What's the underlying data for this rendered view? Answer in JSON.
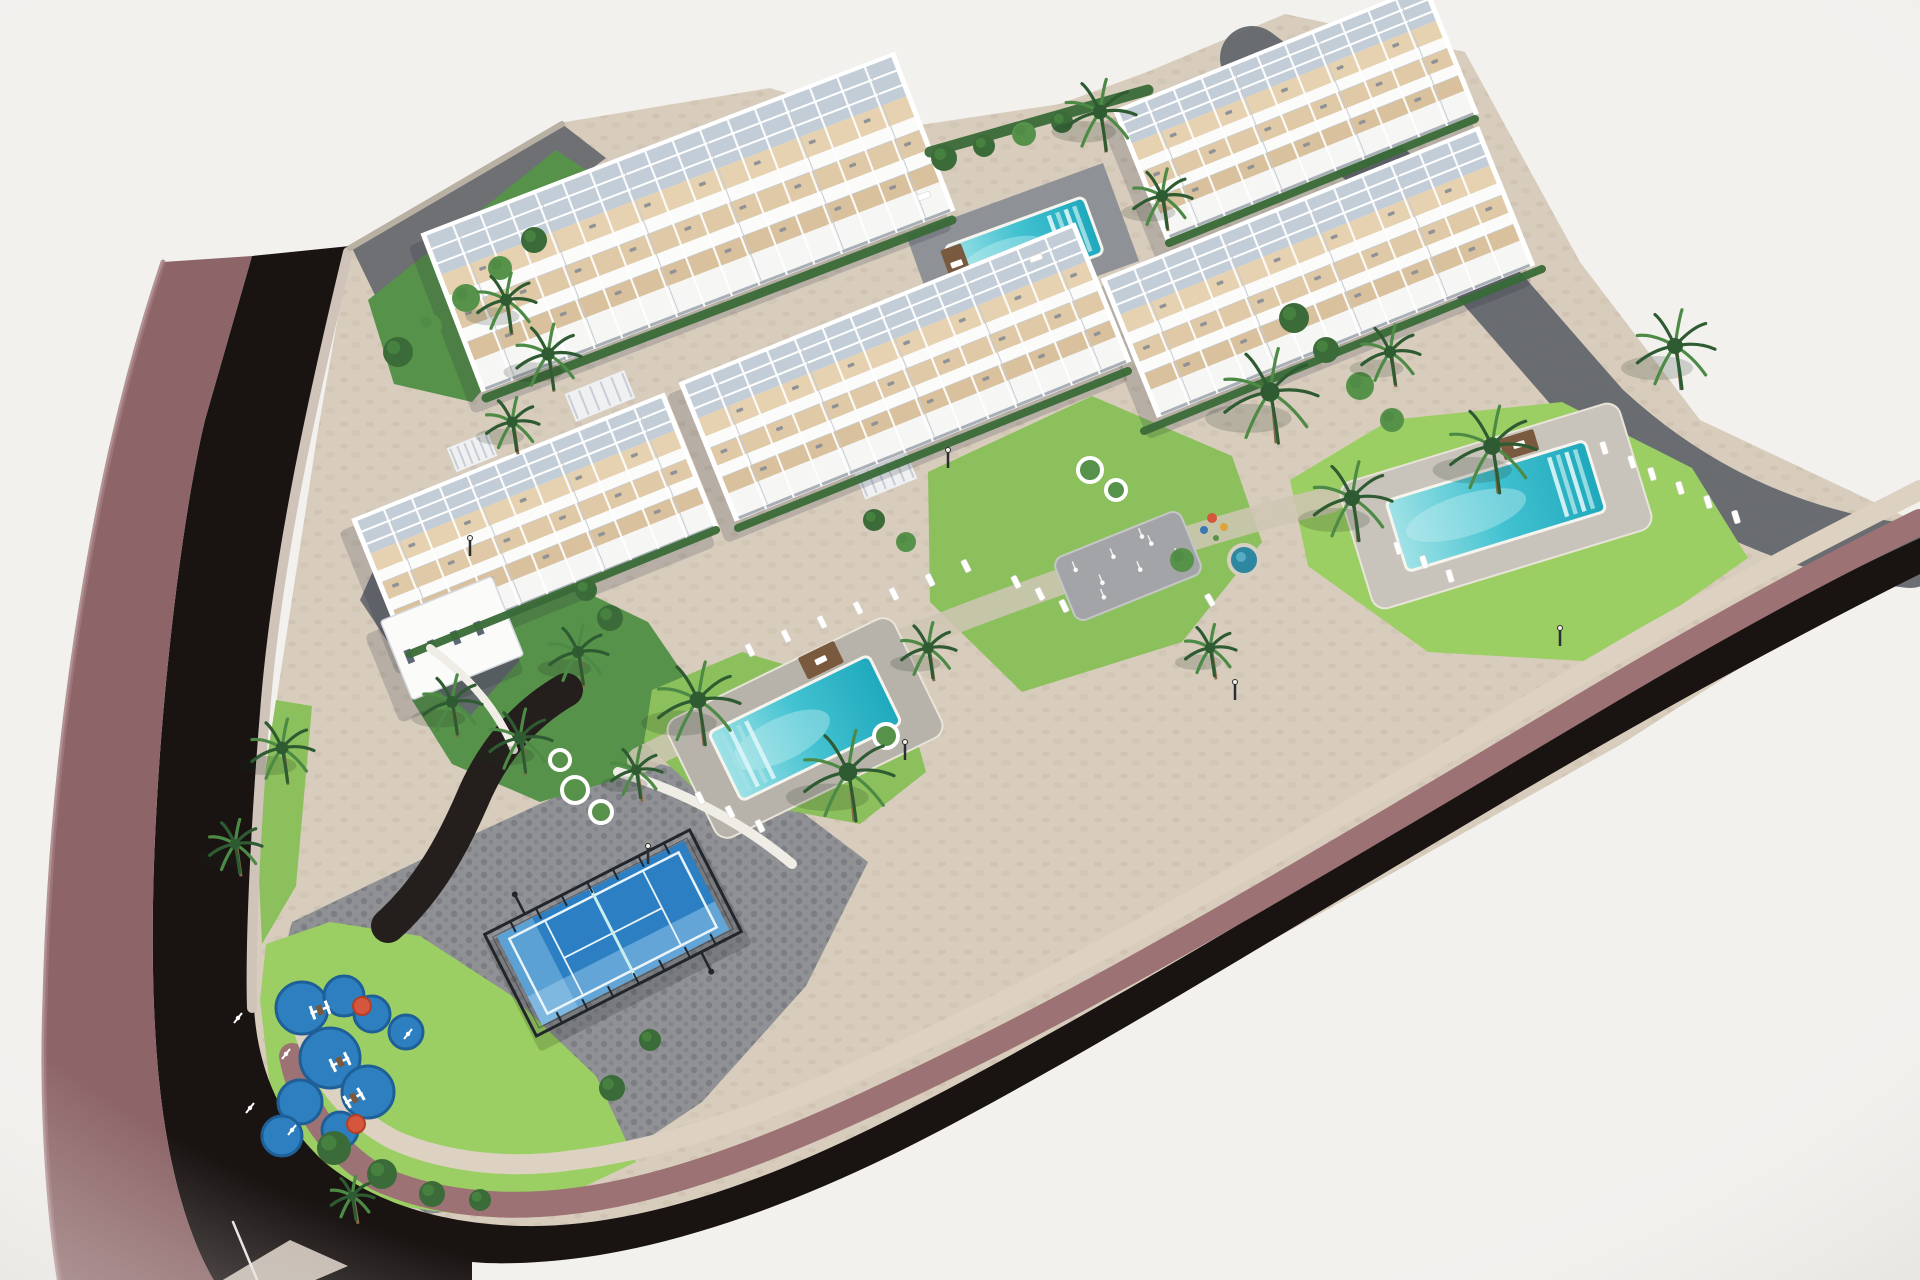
{
  "meta": {
    "type": "architectural-aerial-3d-render",
    "subject": "Aerial master-plan render of a white terraced apartment complex with swimming pools, gardens, palm trees, padel court and playground beside a curving dark road"
  },
  "palette": {
    "bg": "#f2f1ee",
    "road": "#191312",
    "sidewalk": "#8d6568",
    "sidewalk_hi": "#a17b7d",
    "curb": "#cfc3ba",
    "wall": "#9c7274",
    "cap": "#ddd1c2",
    "site": "#d8cdbd",
    "speck": "#c9bcab",
    "paving_dark": "#63666c",
    "pavers": "#8f9195",
    "paver_dot": "#7c7e83",
    "path_light": "#cfc5b4",
    "lawn": "#8cc05c",
    "lawn_bright": "#9ccf63",
    "green_mid": "#57924a",
    "green_dark": "#3a6b38",
    "palm_dark": "#2e5b31",
    "palm_mid": "#4d8a45",
    "trunk": "#8a6a4a",
    "water_hi": "#9fe2e6",
    "water": "#43c2d1",
    "water_deep": "#1fa9bd",
    "deck_p2": "#c9c4bb",
    "deck_p3": "#b8b3aa",
    "deck_dark": "#8e9196",
    "white": "#fbfbfa",
    "beige1": "#e6d2b0",
    "beige2": "#dfc9a6",
    "beige3": "#d8c19c",
    "pergola": "#c3cdd7",
    "slabline": "#c6cbd2",
    "frontline": "#a9afb7",
    "dot": "#8f9296",
    "shadow": "rgba(33,40,56,0.18)",
    "court": "#2b7fc2",
    "court_hi": "#5ea5d8",
    "glass": "#a8d4ef",
    "cage": "#20262c",
    "line_w": "#eaf4fb",
    "play": "#2e7fc0",
    "play_dark": "#1f5f97",
    "red": "#d4573d",
    "splash": "#a3a4a7",
    "wood": "#7a5a3e",
    "white_wall": "#efede6"
  },
  "scene": {
    "w": 1920,
    "h": 1280,
    "base": "350,248 565,122 770,88 900,128 1060,104 1152,70 1285,14 1465,52 1580,262 1700,420 1912,520 1908,560 1620,745 1300,925 1000,1085 760,1185 560,1240 400,1262 285,1215 248,1100 248,950 278,690 318,430",
    "areas": [
      {
        "name": "paving-topleft",
        "pts": "352,248 562,124 606,158 388,322",
        "fill": "@paving_dark",
        "op": 0.9
      },
      {
        "name": "garden-topleft",
        "pts": "368,300 556,150 628,198 588,268 472,402 394,384",
        "fill": "@green_mid"
      },
      {
        "name": "wall-band-topright",
        "d": "M 1252,58 C 1390,160 1500,300 1600,412 C 1700,505 1810,545 1910,556",
        "stroke": "@paving_dark",
        "sw": 64,
        "op": 0.95
      },
      {
        "name": "plaza-pavers",
        "pts": "292,922 470,836 640,758 786,800 868,862 806,986 702,1102 562,1196 428,1214 330,1162 284,1062 276,982",
        "fill": "url(#pav)"
      },
      {
        "name": "lawn-left-strip",
        "pts": "276,700 312,706 296,886 262,944 258,856 266,766",
        "fill": "@lawn"
      },
      {
        "name": "lawn-bottom-corner",
        "pts": "266,944 330,922 420,936 512,996 596,1076 636,1162 556,1200 458,1214 368,1202 303,1158 270,1088 260,1000",
        "fill": "@lawn_bright"
      },
      {
        "name": "garden-above-court",
        "pts": "404,622 540,570 648,622 700,698 642,772 540,802 452,764 412,700",
        "fill": "@green_mid"
      },
      {
        "name": "garden-dark-path",
        "d": "M 566,690 C 524,714 492,752 472,800 C 452,846 428,890 388,926",
        "stroke": "#241f1d",
        "sw": 34
      },
      {
        "name": "lawn-around-pool3",
        "pts": "652,690 742,652 906,700 926,772 860,824 700,794 644,742",
        "fill": "@lawn"
      },
      {
        "name": "lawn-center-garden",
        "pts": "928,472 1092,396 1232,456 1262,542 1182,642 1022,692 930,602",
        "fill": "@lawn"
      },
      {
        "name": "lawn-pool2",
        "pts": "1290,480 1390,420 1562,402 1692,468 1748,558 1600,662 1428,652 1308,566",
        "fill": "@lawn_bright"
      },
      {
        "name": "walkway-center",
        "d": "M 640,760 C 760,700 900,640 1010,600 C 1130,556 1240,520 1330,500",
        "stroke": "@path_light",
        "sw": 26,
        "op": 0.85
      },
      {
        "name": "driveway-b5",
        "pts": "378,560 470,600 520,660 470,716 400,660 360,600",
        "fill": "@paving_dark",
        "op": 0.92
      },
      {
        "name": "deck-pool1-dark",
        "pts": "906,235 1103,163 1139,261 941,333",
        "fill": "@deck_dark"
      },
      {
        "name": "road",
        "d": "M 252,256 L 350,246 C 312,408 280,560 268,700 C 258,820 252,940 254,1008 C 258,1072 282,1122 322,1160 C 372,1203 442,1224 522,1226 C 622,1228 742,1193 882,1123 C 1062,1033 1302,888 1522,753 C 1682,656 1822,583 1920,538 L 1920,574 C 1812,628 1662,708 1502,803 C 1282,933 1062,1070 902,1150 C 782,1210 662,1250 562,1260 C 522,1264 492,1264 472,1262 L 472,1284 L 216,1284 C 186,1235 167,1160 159,1080 C 151,1000 151,900 157,800 C 163,690 181,520 205,420 Z",
        "fill": "@road"
      },
      {
        "name": "sidewalk-left",
        "d": "M 252,256 L 205,420 C 181,520 163,690 157,800 C 151,900 151,1000 159,1080 C 167,1160 186,1235 216,1284 L 60,1284 C 45,1190 42,1080 45,1000 C 48,880 58,760 76,640 C 95,515 120,390 163,262 Z",
        "fill": "@sidewalk"
      },
      {
        "name": "sidewalk-highlight",
        "d": "M 163,262 C 120,390 95,515 76,640 C 58,760 48,880 45,1000 C 42,1080 45,1190 60,1284",
        "stroke": "@sidewalk_hi",
        "sw": 5,
        "op": 0.8
      },
      {
        "name": "curb-wedge",
        "pts": "216,1284 290,1240 348,1266 306,1284",
        "fill": "@curb",
        "op": 0.95
      },
      {
        "name": "wall-face-band",
        "d": "M 292,1056 C 302,1108 332,1150 378,1178 C 432,1203 502,1209 564,1202 C 684,1190 824,1128 984,1048 C 1184,948 1424,800 1624,682 C 1764,600 1854,554 1920,522",
        "stroke": "@wall",
        "sw": 26
      },
      {
        "name": "stone-cap-band",
        "d": "M 300,1016 C 314,1076 348,1116 394,1140 C 449,1164 514,1169 574,1160 C 694,1146 834,1086 994,1006 C 1194,906 1434,760 1634,643 C 1774,563 1864,519 1920,490",
        "stroke": "@cap",
        "sw": 20
      },
      {
        "name": "curb-left-inner",
        "d": "M 348,252 C 310,410 278,560 266,700 C 256,820 250,940 252,1008",
        "stroke": "@curb",
        "sw": 10
      },
      {
        "name": "wall-top-left",
        "d": "M 350,248 L 562,124",
        "stroke": "#b9b0a4",
        "sw": 6
      },
      {
        "name": "road-seam-line",
        "d": "M 233,1222 L 258,1282",
        "stroke": "#e9e7e3",
        "sw": 2.5
      }
    ],
    "building_bands": [
      [
        0.27,
        "pergola"
      ],
      [
        0.13,
        "b1"
      ],
      [
        0.085,
        "w"
      ],
      [
        0.125,
        "b2"
      ],
      [
        0.085,
        "w"
      ],
      [
        0.115,
        "b3"
      ],
      [
        0.19,
        "front"
      ]
    ],
    "buildings": [
      {
        "name": "building-top-right",
        "cx": 1296,
        "cy": 112,
        "len": 330,
        "dep": 140,
        "ang": -22
      },
      {
        "name": "building-right",
        "cx": 1318,
        "cy": 272,
        "len": 400,
        "dep": 150,
        "ang": -22
      },
      {
        "name": "building-top-center",
        "cx": 688,
        "cy": 222,
        "len": 500,
        "dep": 170,
        "ang": -21
      },
      {
        "name": "building-center",
        "cx": 905,
        "cy": 372,
        "len": 420,
        "dep": 150,
        "ang": -22
      },
      {
        "name": "building-left",
        "cx": 535,
        "cy": 523,
        "len": 330,
        "dep": 145,
        "ang": -22
      },
      {
        "name": "building-left-annex",
        "cx": 452,
        "cy": 638,
        "len": 120,
        "dep": 85,
        "ang": -22,
        "simple": true
      }
    ],
    "pools": [
      {
        "name": "pool-top",
        "cx": 1024,
        "cy": 250,
        "len": 148,
        "dep": 60,
        "ang": -20,
        "steps": "right",
        "wood": [
          -68,
          -10,
          22,
          36
        ]
      },
      {
        "name": "pool-right",
        "cx": 1496,
        "cy": 506,
        "len": 208,
        "dep": 74,
        "ang": -17,
        "steps": "right",
        "deck": [
          292,
          132,
          "@deck_p2"
        ],
        "wood": [
          40,
          -52,
          36,
          22
        ]
      },
      {
        "name": "pool-center",
        "cx": 805,
        "cy": 728,
        "len": 178,
        "dep": 76,
        "ang": -26,
        "steps": "left",
        "deck": [
          252,
          132,
          "@deck_p3"
        ],
        "wood": [
          44,
          -54,
          40,
          24
        ]
      }
    ],
    "padel": {
      "name": "padel-court",
      "cx": 613,
      "cy": 933,
      "ang": -27,
      "cageW": 230,
      "cageH": 114,
      "surfW": 210,
      "surfH": 100
    },
    "playground": {
      "name": "playground",
      "circles": [
        [
          302,
          1008,
          26
        ],
        [
          344,
          996,
          20
        ],
        [
          372,
          1014,
          18
        ],
        [
          330,
          1058,
          30
        ],
        [
          300,
          1102,
          22
        ],
        [
          368,
          1092,
          26
        ],
        [
          406,
          1032,
          17
        ],
        [
          282,
          1136,
          20
        ],
        [
          340,
          1130,
          18
        ]
      ],
      "reds": [
        [
          362,
          1006,
          9
        ],
        [
          356,
          1124,
          9
        ]
      ],
      "equip": [
        [
          320,
          1010,
          -20
        ],
        [
          340,
          1062,
          -25
        ],
        [
          354,
          1098,
          -30
        ]
      ],
      "fitness": [
        [
          286,
          1054
        ],
        [
          292,
          1130
        ],
        [
          408,
          1034
        ],
        [
          238,
          1018
        ],
        [
          250,
          1108
        ]
      ]
    },
    "splash": {
      "name": "splash-pad",
      "cx": 1128,
      "cy": 566,
      "ang": -22,
      "w": 136,
      "h": 68,
      "jets": [
        [
          -50,
          -16
        ],
        [
          -30,
          6
        ],
        [
          -10,
          -14
        ],
        [
          10,
          8
        ],
        [
          30,
          -12
        ],
        [
          50,
          10
        ],
        [
          -34,
          20
        ],
        [
          24,
          -22
        ]
      ]
    },
    "spa": {
      "name": "spa-circle",
      "cx": 1244,
      "cy": 560,
      "r": 15
    },
    "accents": [
      [
        1212,
        518,
        "@red",
        5
      ],
      [
        1224,
        527,
        "#e0a33a",
        4
      ],
      [
        1204,
        530,
        "#3a78b5",
        4
      ],
      [
        1216,
        538,
        "@green_mid",
        3
      ]
    ],
    "palms": [
      [
        506,
        300,
        30
      ],
      [
        548,
        354,
        33
      ],
      [
        512,
        422,
        27
      ],
      [
        1100,
        112,
        36
      ],
      [
        1162,
        196,
        30
      ],
      [
        1675,
        346,
        40
      ],
      [
        1390,
        352,
        30
      ],
      [
        1492,
        446,
        44
      ],
      [
        1270,
        392,
        48
      ],
      [
        1352,
        498,
        40
      ],
      [
        848,
        772,
        46
      ],
      [
        698,
        700,
        42
      ],
      [
        578,
        652,
        30
      ],
      [
        636,
        770,
        26
      ],
      [
        282,
        748,
        32
      ],
      [
        235,
        844,
        27
      ],
      [
        352,
        1196,
        22
      ],
      [
        452,
        702,
        30
      ],
      [
        520,
        738,
        32
      ],
      [
        928,
        648,
        28
      ],
      [
        1210,
        648,
        26
      ]
    ],
    "bushes": [
      [
        398,
        352,
        15
      ],
      [
        430,
        326,
        12
      ],
      [
        466,
        298,
        14
      ],
      [
        500,
        268,
        12
      ],
      [
        534,
        240,
        13
      ],
      [
        944,
        158,
        13
      ],
      [
        984,
        146,
        11
      ],
      [
        1024,
        134,
        12
      ],
      [
        1062,
        122,
        11
      ],
      [
        1294,
        318,
        15
      ],
      [
        1326,
        350,
        13
      ],
      [
        1360,
        386,
        14
      ],
      [
        1392,
        420,
        12
      ],
      [
        334,
        1148,
        17
      ],
      [
        382,
        1174,
        15
      ],
      [
        432,
        1194,
        13
      ],
      [
        480,
        1200,
        11
      ],
      [
        612,
        1088,
        13
      ],
      [
        650,
        1040,
        11
      ],
      [
        1182,
        560,
        12
      ],
      [
        874,
        520,
        11
      ],
      [
        610,
        618,
        13
      ],
      [
        586,
        590,
        11
      ],
      [
        906,
        542,
        10
      ]
    ],
    "hedges": [
      [
        486,
        398,
        952,
        220,
        9
      ],
      [
        738,
        528,
        1128,
        371,
        8
      ],
      [
        1144,
        431,
        1542,
        269,
        8
      ],
      [
        1169,
        243,
        1475,
        119,
        8
      ],
      [
        410,
        654,
        716,
        530,
        8
      ],
      [
        930,
        152,
        1148,
        90,
        11
      ]
    ],
    "loungers": [
      [
        750,
        650,
        64
      ],
      [
        786,
        636,
        64
      ],
      [
        822,
        622,
        64
      ],
      [
        858,
        608,
        64
      ],
      [
        894,
        594,
        64
      ],
      [
        930,
        580,
        64
      ],
      [
        966,
        566,
        64
      ],
      [
        700,
        798,
        64
      ],
      [
        730,
        812,
        64
      ],
      [
        760,
        826,
        64
      ],
      [
        1652,
        474,
        73
      ],
      [
        1680,
        488,
        73
      ],
      [
        1708,
        502,
        73
      ],
      [
        1736,
        517,
        73
      ],
      [
        1398,
        548,
        73
      ],
      [
        1424,
        562,
        73
      ],
      [
        1450,
        576,
        73
      ],
      [
        1604,
        448,
        73
      ],
      [
        1632,
        462,
        73
      ],
      [
        1036,
        258,
        -20
      ],
      [
        924,
        196,
        -20
      ],
      [
        1016,
        582,
        64
      ],
      [
        1040,
        594,
        64
      ],
      [
        1064,
        606,
        64
      ],
      [
        1210,
        600,
        60
      ]
    ],
    "planters": [
      [
        575,
        790,
        13
      ],
      [
        601,
        812,
        11
      ],
      [
        886,
        736,
        12
      ],
      [
        1090,
        470,
        12
      ],
      [
        1116,
        490,
        10
      ],
      [
        560,
        760,
        10
      ]
    ],
    "poles": [
      [
        470,
        556
      ],
      [
        948,
        468
      ],
      [
        1235,
        700
      ],
      [
        1560,
        646
      ],
      [
        648,
        864
      ],
      [
        905,
        760
      ]
    ],
    "stairs": [
      [
        600,
        396,
        -22,
        64,
        30
      ],
      [
        472,
        452,
        -22,
        44,
        26
      ],
      [
        886,
        476,
        -22,
        56,
        28
      ]
    ],
    "walls": [
      {
        "name": "pool-center-white-wall",
        "d": "M 618,772 C 680,790 742,822 792,864",
        "sw": 10
      },
      {
        "name": "ramp-white-wall",
        "d": "M 430,648 C 468,676 498,710 514,750",
        "sw": 8
      }
    ]
  }
}
